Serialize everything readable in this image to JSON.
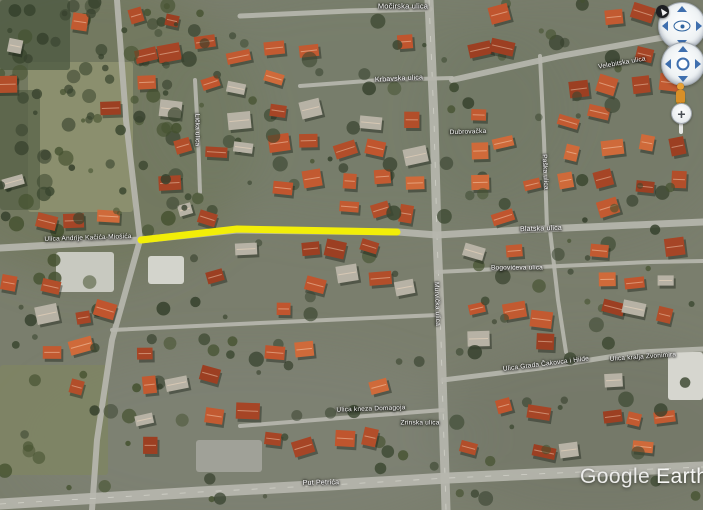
{
  "watermark": {
    "google": "Google",
    "earth": "Earth"
  },
  "controls": {
    "zoom_in_glyph": "+",
    "items": [
      {
        "name": "north-arrow-icon"
      },
      {
        "name": "look-joystick"
      },
      {
        "name": "move-joystick"
      },
      {
        "name": "pegman-icon"
      },
      {
        "name": "zoom-in-icon"
      }
    ]
  },
  "map": {
    "base_color": "#7a7e6d",
    "road_color": "#b6b6ae",
    "route_color": "#f2ee08",
    "roof_palette": [
      "#b24e2a",
      "#c25a31",
      "#a64526",
      "#cf6a3a",
      "#9c3f22",
      "#c0552e"
    ],
    "gray_roof_color": "#b7b2a5",
    "tree_palette": [
      "#3a462f",
      "#44512f",
      "#35402c"
    ],
    "route": {
      "points": [
        [
          141,
          240
        ],
        [
          237,
          229
        ],
        [
          397,
          232
        ]
      ],
      "width": 7
    },
    "labels": [
      {
        "text": "Močirska ulica",
        "x": 403,
        "y": 6,
        "rot": 0,
        "size": 7.5
      },
      {
        "text": "Krbavska ulica",
        "x": 399,
        "y": 79,
        "rot": -3,
        "size": 7
      },
      {
        "text": "Ulica Andrije Kačića-Miošića",
        "x": 88,
        "y": 238,
        "rot": -2,
        "size": 6.5
      },
      {
        "text": "Dubrovačka",
        "x": 468,
        "y": 132,
        "rot": -2,
        "size": 6.5
      },
      {
        "text": "Blatska ulica",
        "x": 541,
        "y": 229,
        "rot": -2,
        "size": 7
      },
      {
        "text": "Bogovićeva ulica",
        "x": 517,
        "y": 268,
        "rot": 0,
        "size": 6.5
      },
      {
        "text": "Ulica Grada Čakovca i Hilde",
        "x": 546,
        "y": 364,
        "rot": -7,
        "size": 6.5
      },
      {
        "text": "Ulica kralja Zvonimira",
        "x": 643,
        "y": 357,
        "rot": -4,
        "size": 6.5
      },
      {
        "text": "Ulica kneza Domagoja",
        "x": 371,
        "y": 409,
        "rot": -2,
        "size": 6.5
      },
      {
        "text": "Zrinska ulica",
        "x": 420,
        "y": 423,
        "rot": 0,
        "size": 6.5
      },
      {
        "text": "Put Petrića",
        "x": 321,
        "y": 483,
        "rot": -1,
        "size": 7
      },
      {
        "text": "Lička ulica",
        "x": 197,
        "y": 130,
        "rot": 90,
        "size": 6.5
      },
      {
        "text": "Murvička ulica",
        "x": 437,
        "y": 304,
        "rot": 88,
        "size": 6.5
      },
      {
        "text": "Paška ulica",
        "x": 545,
        "y": 172,
        "rot": 87,
        "size": 6.5
      },
      {
        "text": "Velebitska ulica",
        "x": 622,
        "y": 63,
        "rot": -10,
        "size": 6.5
      }
    ],
    "roads": [
      {
        "points": [
          [
            429,
            0
          ],
          [
            434,
            120
          ],
          [
            437,
            236
          ],
          [
            441,
            340
          ],
          [
            446,
            510
          ]
        ],
        "w": 9,
        "dash": true
      },
      {
        "points": [
          [
            0,
            248
          ],
          [
            140,
            240
          ],
          [
            237,
            230
          ],
          [
            398,
            232
          ],
          [
            437,
            235
          ],
          [
            520,
            230
          ],
          [
            703,
            222
          ]
        ],
        "w": 7,
        "dash": false
      },
      {
        "points": [
          [
            117,
            0
          ],
          [
            126,
            120
          ],
          [
            140,
            240
          ],
          [
            112,
            340
          ],
          [
            97,
            440
          ],
          [
            92,
            510
          ]
        ],
        "w": 6,
        "dash": false
      },
      {
        "points": [
          [
            0,
            504
          ],
          [
            200,
            492
          ],
          [
            330,
            485
          ],
          [
            448,
            478
          ],
          [
            580,
            472
          ],
          [
            703,
            467
          ]
        ],
        "w": 11,
        "dash": true
      },
      {
        "points": [
          [
            240,
            16
          ],
          [
            350,
            11
          ],
          [
            430,
            9
          ]
        ],
        "w": 5,
        "dash": false
      },
      {
        "points": [
          [
            452,
            80
          ],
          [
            560,
            56
          ],
          [
            660,
            38
          ],
          [
            703,
            32
          ]
        ],
        "w": 6,
        "dash": false
      },
      {
        "points": [
          [
            540,
            56
          ],
          [
            544,
            140
          ],
          [
            547,
            228
          ]
        ],
        "w": 4,
        "dash": false
      },
      {
        "points": [
          [
            437,
            272
          ],
          [
            560,
            266
          ],
          [
            650,
            262
          ],
          [
            703,
            261
          ]
        ],
        "w": 4,
        "dash": false
      },
      {
        "points": [
          [
            443,
            380
          ],
          [
            540,
            368
          ],
          [
            640,
            352
          ],
          [
            703,
            349
          ]
        ],
        "w": 5,
        "dash": false
      },
      {
        "points": [
          [
            112,
            330
          ],
          [
            260,
            323
          ],
          [
            438,
            315
          ]
        ],
        "w": 4,
        "dash": false
      },
      {
        "points": [
          [
            240,
            426
          ],
          [
            340,
            418
          ],
          [
            443,
            410
          ]
        ],
        "w": 4,
        "dash": false
      },
      {
        "points": [
          [
            195,
            80
          ],
          [
            198,
            135
          ],
          [
            200,
            192
          ]
        ],
        "w": 4,
        "dash": false
      },
      {
        "points": [
          [
            300,
            86
          ],
          [
            380,
            80
          ],
          [
            452,
            78
          ]
        ],
        "w": 4,
        "dash": false
      },
      {
        "points": [
          [
            550,
            230
          ],
          [
            558,
            300
          ],
          [
            566,
            352
          ]
        ],
        "w": 4,
        "dash": false
      }
    ],
    "patches": [
      {
        "x": 28,
        "y": 62,
        "w": 105,
        "h": 150,
        "fill": "#8f9371",
        "o": 0.85,
        "t": "f"
      },
      {
        "x": 0,
        "y": 365,
        "w": 108,
        "h": 110,
        "fill": "#7e8464",
        "o": 0.9,
        "t": "f"
      },
      {
        "x": 196,
        "y": 440,
        "w": 66,
        "h": 32,
        "fill": "#a2a29a",
        "o": 0.95,
        "t": "p"
      },
      {
        "x": 56,
        "y": 252,
        "w": 58,
        "h": 40,
        "fill": "#c8c9c0",
        "o": 1,
        "t": "b"
      },
      {
        "x": 148,
        "y": 256,
        "w": 36,
        "h": 28,
        "fill": "#d3d4cc",
        "o": 1,
        "t": "b"
      },
      {
        "x": 668,
        "y": 352,
        "w": 35,
        "h": 48,
        "fill": "#d6d6cf",
        "o": 1,
        "t": "b"
      },
      {
        "x": 0,
        "y": 0,
        "w": 70,
        "h": 70,
        "fill": "#4e5a42",
        "o": 0.8,
        "t": "w"
      },
      {
        "x": 0,
        "y": 90,
        "w": 40,
        "h": 120,
        "fill": "#556046",
        "o": 0.7,
        "t": "w"
      }
    ],
    "tones": [
      {
        "cx": 90,
        "cy": 130,
        "rx": 170,
        "ry": 150,
        "fill": "#6b7354",
        "o": 0.5
      },
      {
        "cx": 360,
        "cy": 110,
        "rx": 210,
        "ry": 120,
        "fill": "#747a66",
        "o": 0.35
      },
      {
        "cx": 580,
        "cy": 120,
        "rx": 160,
        "ry": 130,
        "fill": "#6e7560",
        "o": 0.35
      },
      {
        "cx": 250,
        "cy": 440,
        "rx": 230,
        "ry": 90,
        "fill": "#84867a",
        "o": 0.35
      },
      {
        "cx": 600,
        "cy": 430,
        "rx": 170,
        "ry": 90,
        "fill": "#6f7463",
        "o": 0.4
      }
    ]
  }
}
